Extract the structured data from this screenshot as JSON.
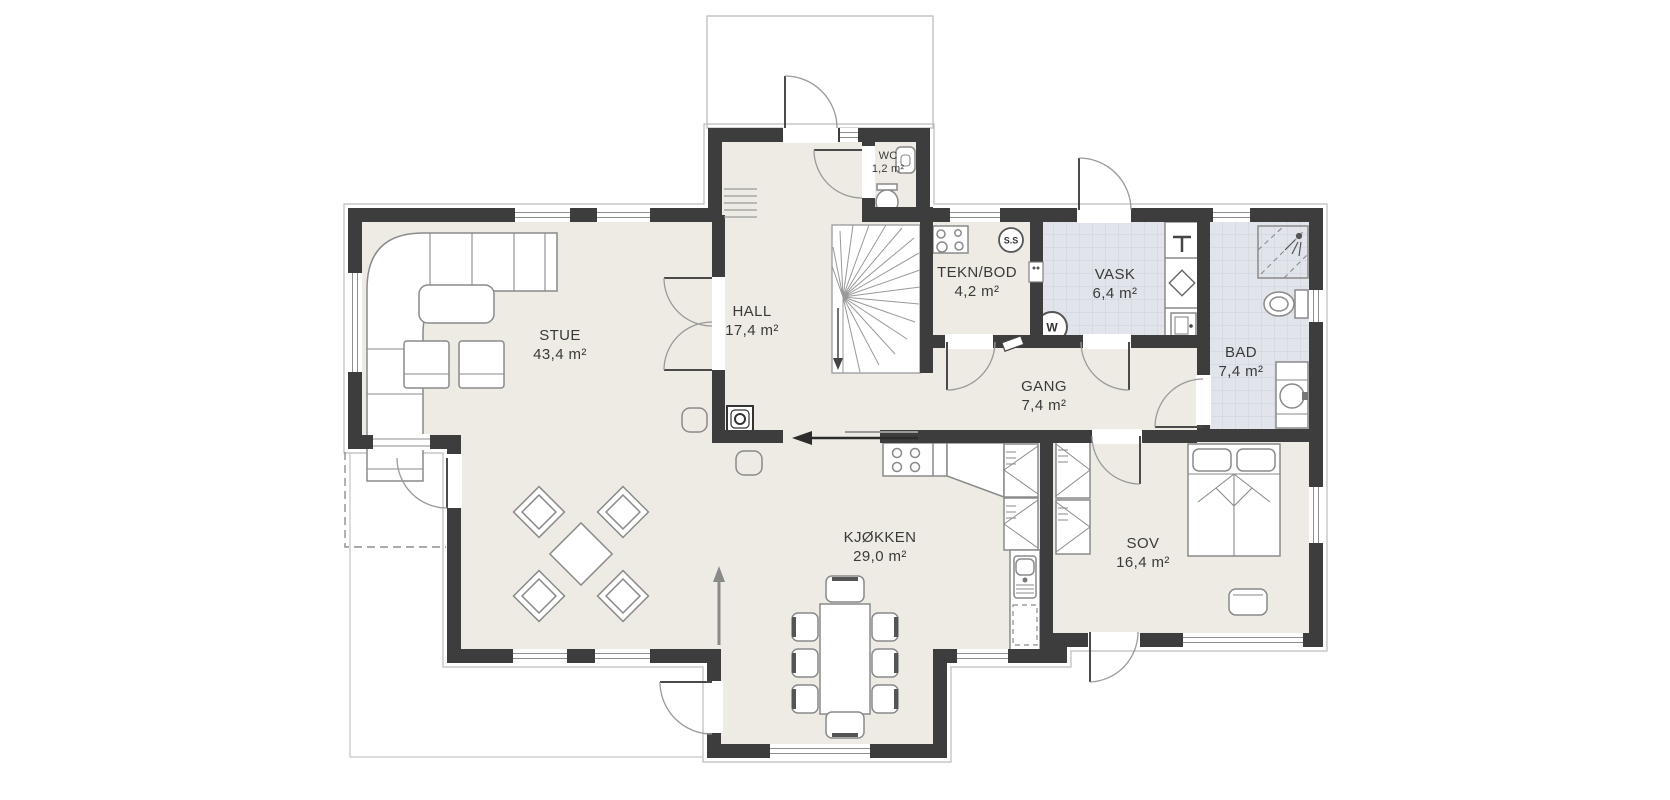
{
  "plan": {
    "type": "floor-plan",
    "floor": "main-floor",
    "rooms": [
      {
        "name": "STUE",
        "area": "43,4 m²"
      },
      {
        "name": "HALL",
        "area": "17,4 m²"
      },
      {
        "name": "WC",
        "area": "1,2 m²"
      },
      {
        "name": "TEKN/BOD",
        "area": "4,2 m²"
      },
      {
        "name": "VASK",
        "area": "6,4 m²"
      },
      {
        "name": "BAD",
        "area": "7,4 m²"
      },
      {
        "name": "GANG",
        "area": "7,4 m²"
      },
      {
        "name": "KJØKKEN",
        "area": "29,0 m²"
      },
      {
        "name": "SOV",
        "area": "16,4 m²"
      }
    ],
    "symbols": {
      "ss": "S.S",
      "washer": "W"
    },
    "colors": {
      "wall": "#3d3d3d",
      "floor": "#edebe3",
      "wet_floor": "#e1e4ea",
      "tile_line": "#ccd0d9",
      "furniture_line": "#8a8a8a",
      "outline": "#bcbcbc"
    }
  }
}
